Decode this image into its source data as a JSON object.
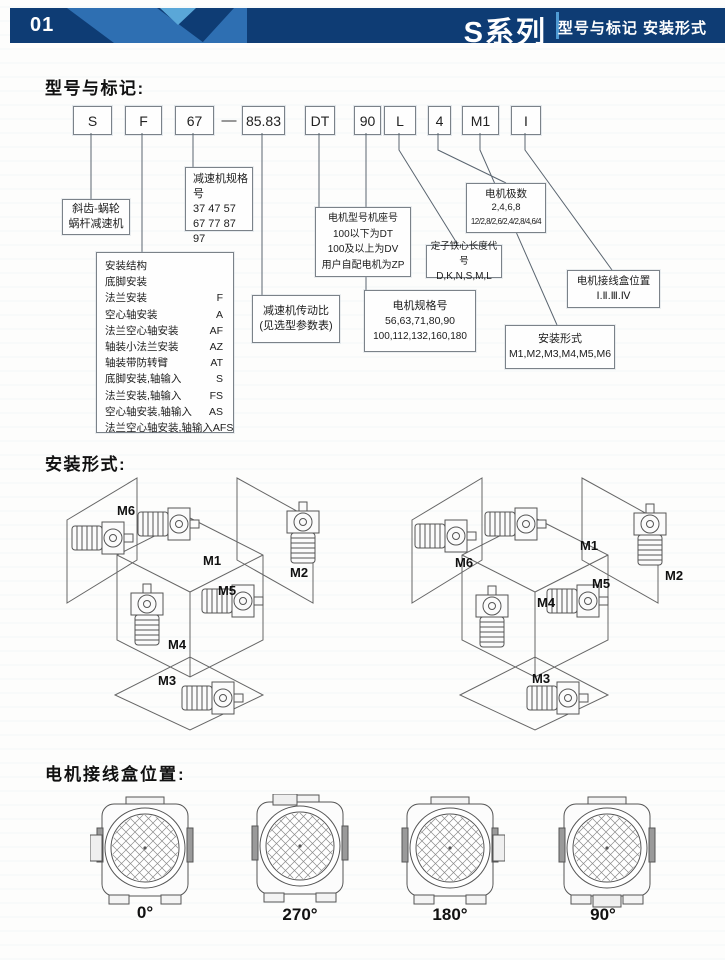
{
  "header": {
    "page_number": "01",
    "series_title": "S系列",
    "subtitle": "型号与标记 安装形式",
    "colors": {
      "navy": "#0e3c74",
      "medium_blue": "#2e6fb2",
      "light_blue": "#5aa7d8"
    }
  },
  "model_section": {
    "title": "型号与标记:",
    "separator": "—",
    "code_boxes": [
      "S",
      "F",
      "67",
      "85.83",
      "DT",
      "90",
      "L",
      "4",
      "M1",
      "I"
    ],
    "annotations": {
      "reducer_type": {
        "lines": [
          "斜齿-蜗轮",
          "蜗杆减速机"
        ]
      },
      "reducer_size": {
        "title": "减速机规格号",
        "lines": [
          "37  47  57",
          "67  77  87",
          "97"
        ]
      },
      "mount_structure": {
        "title": "安装结构",
        "rows": [
          {
            "label": "底脚安装",
            "code": ""
          },
          {
            "label": "法兰安装",
            "code": "F"
          },
          {
            "label": "空心轴安装",
            "code": "A"
          },
          {
            "label": "法兰空心轴安装",
            "code": "AF"
          },
          {
            "label": "轴装小法兰安装",
            "code": "AZ"
          },
          {
            "label": "轴装带防转臂",
            "code": "AT"
          },
          {
            "label": "底脚安装,轴输入",
            "code": "S"
          },
          {
            "label": "法兰安装,轴输入",
            "code": "FS"
          },
          {
            "label": "空心轴安装,轴输入",
            "code": "AS"
          },
          {
            "label": "法兰空心轴安装,轴输入",
            "code": "AFS"
          }
        ]
      },
      "ratio": {
        "lines": [
          "减速机传动比",
          "(见选型参数表)"
        ]
      },
      "motor_model": {
        "lines": [
          "电机型号机座号",
          "100以下为DT",
          "100及以上为DV",
          "用户自配电机为ZP"
        ]
      },
      "motor_size": {
        "title": "电机规格号",
        "lines": [
          "56,63,71,80,90",
          "100,112,132,160,180"
        ]
      },
      "motor_poles": {
        "title": "电机极数",
        "lines": [
          "2,4,6,8",
          "12/2,8/2,6/2,4/2,8/4,6/4"
        ]
      },
      "stator_length": {
        "title": "定子铁心长度代号",
        "lines": [
          "D,K,N,S,M,L"
        ]
      },
      "mount_form": {
        "title": "安装形式",
        "lines": [
          "M1,M2,M3,M4,M5,M6"
        ]
      },
      "junction_position": {
        "title": "电机接线盒位置",
        "lines": [
          "Ⅰ.Ⅱ.Ⅲ.Ⅳ"
        ]
      }
    }
  },
  "installation_section": {
    "title": "安装形式:",
    "diagrams": [
      {
        "labels": {
          "m1": "M1",
          "m2": "M2",
          "m3": "M3",
          "m4": "M4",
          "m5": "M5",
          "m6": "M6"
        }
      },
      {
        "labels": {
          "m1": "M1",
          "m2": "M2",
          "m3": "M3",
          "m4": "M4",
          "m5": "M5",
          "m6": "M6"
        }
      }
    ]
  },
  "junction_section": {
    "title": "电机接线盒位置:",
    "positions": [
      {
        "angle": "0°",
        "box_side": "left"
      },
      {
        "angle": "270°",
        "box_side": "top"
      },
      {
        "angle": "180°",
        "box_side": "right"
      },
      {
        "angle": "90°",
        "box_side": "bottom"
      }
    ]
  }
}
